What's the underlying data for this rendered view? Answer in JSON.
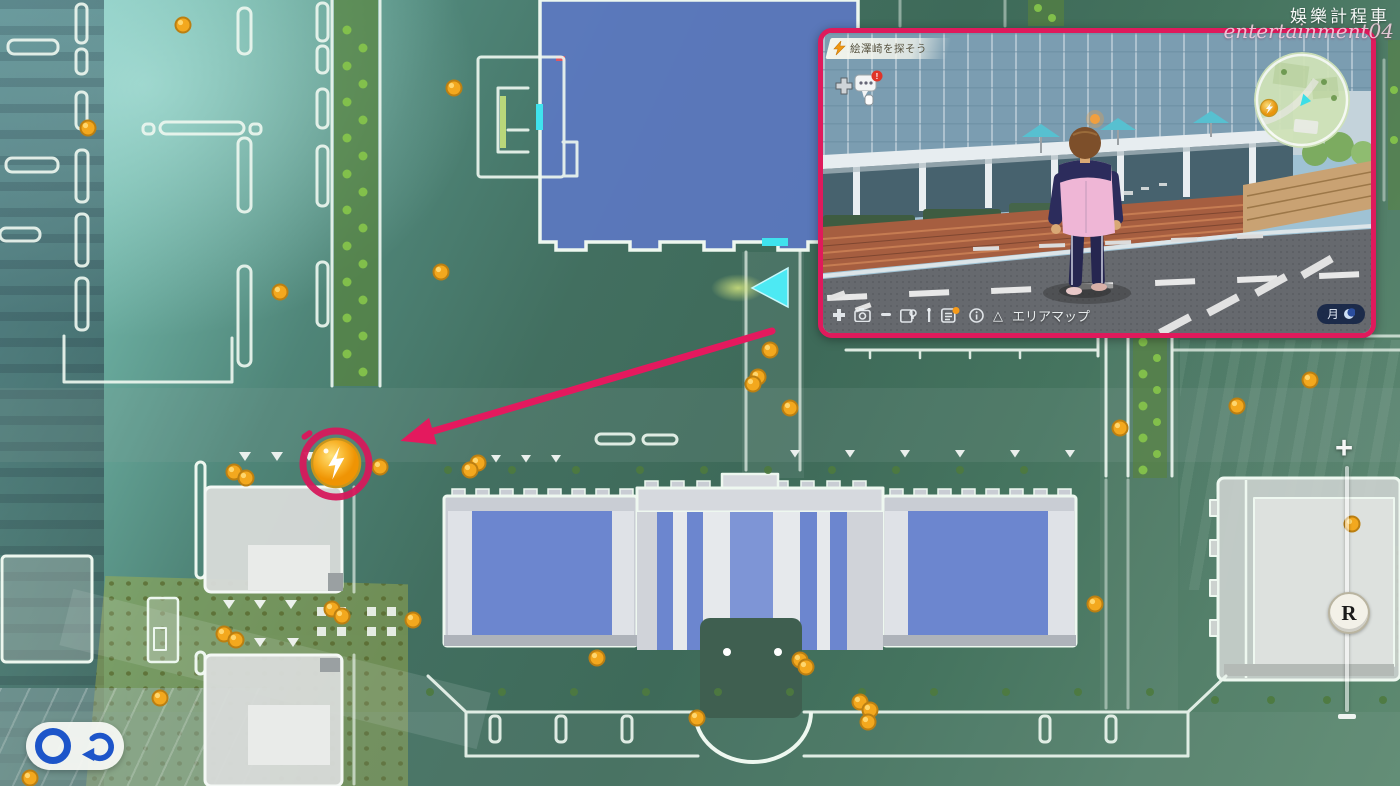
{
  "watermark": {
    "brand": "娛樂計程車",
    "handle": "entertainment04"
  },
  "inset": {
    "quest": {
      "label": "絵澤崎を探そう"
    },
    "toolbar": {
      "area_map_label": "エリアマップ",
      "triangle_glyph": "△"
    },
    "day_badge": {
      "day": "月"
    }
  },
  "controls": {
    "zoom_in": "+",
    "zoom_out": "−",
    "r_button": "R"
  },
  "map": {
    "colors": {
      "accent_pink": "#df1a5c",
      "coin_fill": "#f3a81e",
      "coin_edge": "#bb7f12",
      "line": "#edf7ef",
      "player_marker": "#4de9f3",
      "building_blue": "#6c86cf",
      "water_blue": "#5d79c6"
    },
    "coin_markers": [
      [
        183,
        25
      ],
      [
        88,
        128
      ],
      [
        454,
        88
      ],
      [
        280,
        292
      ],
      [
        441,
        272
      ],
      [
        770,
        350
      ],
      [
        758,
        377
      ],
      [
        753,
        384
      ],
      [
        790,
        408
      ],
      [
        380,
        467
      ],
      [
        478,
        463
      ],
      [
        234,
        472
      ],
      [
        246,
        478
      ],
      [
        470,
        470
      ],
      [
        332,
        609
      ],
      [
        342,
        616
      ],
      [
        224,
        634
      ],
      [
        236,
        640
      ],
      [
        160,
        698
      ],
      [
        413,
        620
      ],
      [
        597,
        658
      ],
      [
        800,
        660
      ],
      [
        806,
        667
      ],
      [
        860,
        702
      ],
      [
        870,
        710
      ],
      [
        697,
        718
      ],
      [
        868,
        722
      ],
      [
        30,
        778
      ],
      [
        1310,
        380
      ],
      [
        1237,
        406
      ],
      [
        1120,
        428
      ],
      [
        1095,
        604
      ],
      [
        1352,
        524
      ]
    ]
  },
  "annotations": {
    "arrow": {
      "x1": 772,
      "y1": 331,
      "x2": 410,
      "y2": 438
    },
    "ring": {
      "cx": 336,
      "cy": 464,
      "r": 33
    },
    "target": {
      "cx": 336,
      "cy": 463,
      "label": "lightning-energy-spot"
    }
  }
}
